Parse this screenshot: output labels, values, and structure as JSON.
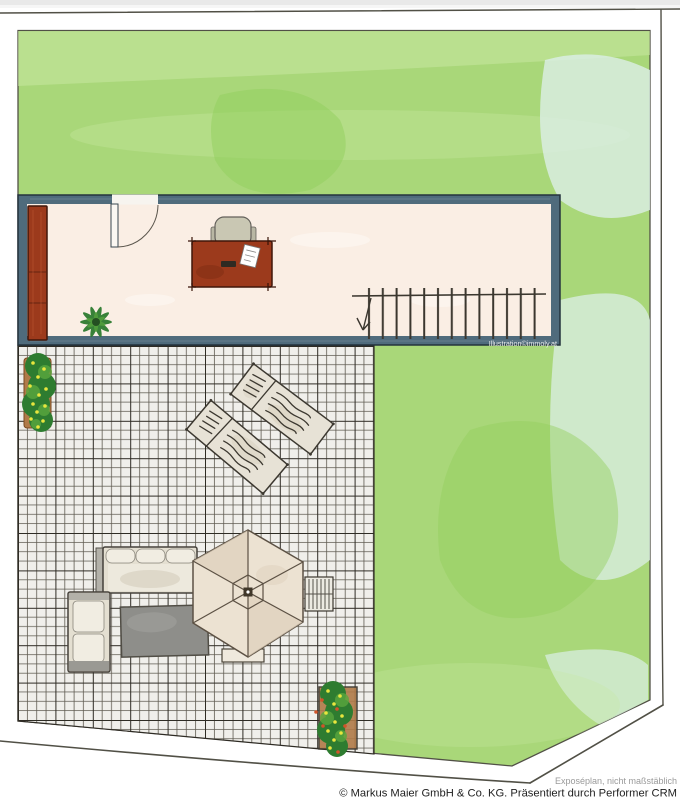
{
  "credits": {
    "illustration": "Illustration©immoly.at",
    "disclaimer": "Exposéplan, nicht maßstäblich",
    "copyright": "© Markus Maier GmbH & Co. KG. Präsentiert durch Performer CRM"
  },
  "colors": {
    "page-bg": "#ffffff",
    "boundary": "#515046",
    "lawn": "#a9d779",
    "lawn-light": "#c8e7a2",
    "lawn-dark": "#92cf5e",
    "lawn-aqua": "#dcefe7",
    "wall": "#4f6b7c",
    "wall-edge": "#24333d",
    "room-floor": "#faeee4",
    "wood": "#9c3a1c",
    "wood-edge": "#40160a",
    "chair": "#c9c7b3",
    "tile-bg": "#f0efeb",
    "tile-line": "#5f5b51",
    "tile-major": "#2e2b24",
    "sofa": "#e4dfd1",
    "sofa-cushion": "#f1ede2",
    "sofa-gray": "#b3b1a9",
    "rug": "#8e8e8a",
    "umbrella": "#ece2d2",
    "umbrella-shade": "#ded0bb",
    "umbrella-line": "#5c5144",
    "lounger": "#e7e2d6",
    "lounger-line": "#3c3830",
    "plant": "#2e7c30",
    "plant-light": "#5aa73e",
    "flower-yellow": "#e8e63e",
    "flower-red": "#d1542a",
    "pot": "#b07a48",
    "stair": "#3b372f",
    "text-muted": "#9a9a9a",
    "text-dark": "#1f1f1f"
  },
  "plan": {
    "areas": {
      "lawn": "garden-lawn",
      "room": "interior-room",
      "terrace": "tiled-terrace"
    },
    "objects": [
      "wardrobe",
      "desk",
      "desk-chair",
      "paper-sheet",
      "indoor-plant",
      "staircase",
      "door",
      "flower-pot-top",
      "sun-lounger-upper",
      "sun-lounger-lower",
      "garden-sofa",
      "corner-bench",
      "outdoor-rug",
      "parasol",
      "folding-chair",
      "side-table",
      "flower-pot-bottom"
    ]
  }
}
